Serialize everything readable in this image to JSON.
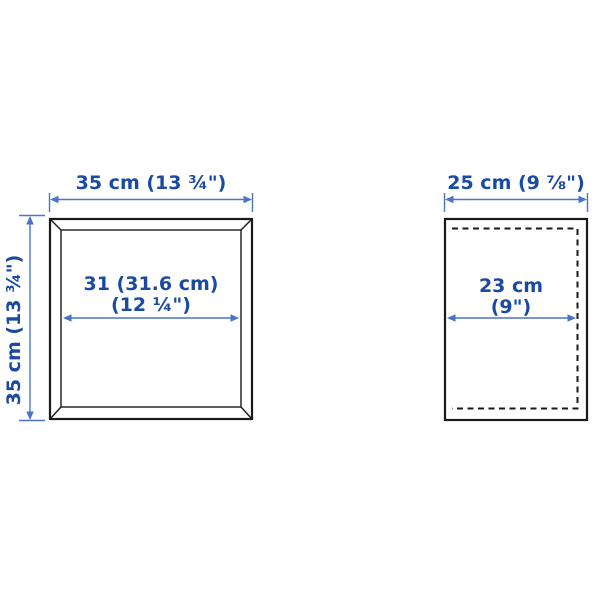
{
  "colors": {
    "dimension_text": "#1a4aa2",
    "dimension_line": "#4a74c8",
    "outline_dark": "#1a1a1a",
    "background": "#ffffff"
  },
  "front_view": {
    "outer_width_label": "35 cm (13 ¾\")",
    "outer_height_label": "35 cm (13 ¾\")",
    "inner_width_line1": "31 (31.6 cm)",
    "inner_width_line2": "(12 ¼\")"
  },
  "side_view": {
    "depth_label": "25 cm (9 ⅞\")",
    "inner_depth_line1": "23 cm",
    "inner_depth_line2": "(9\")"
  }
}
